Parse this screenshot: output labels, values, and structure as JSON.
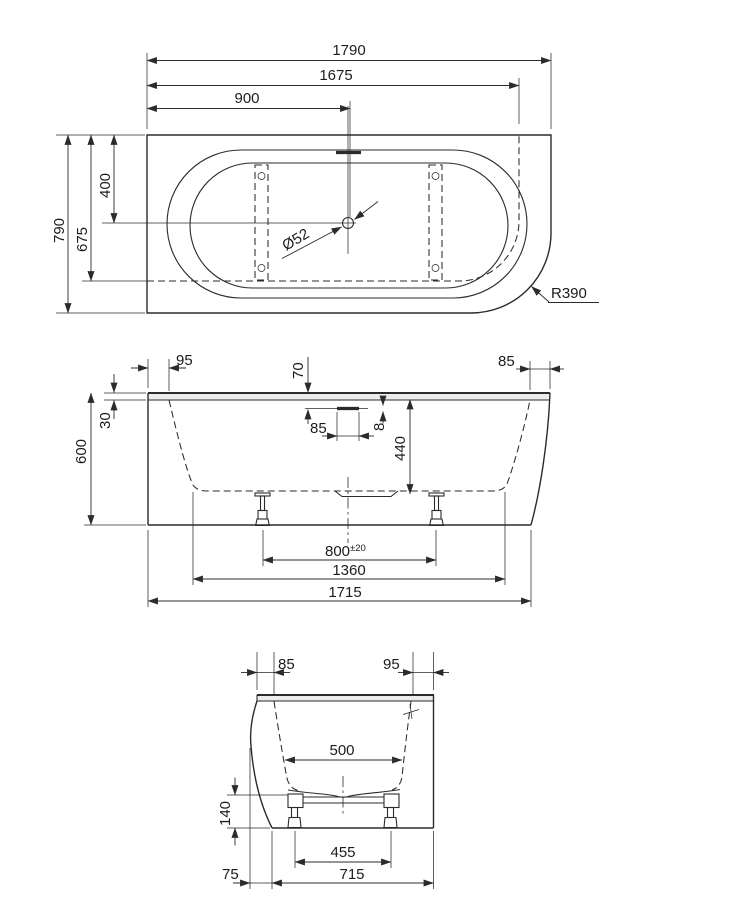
{
  "top_view": {
    "length_overall": "1790",
    "length_to_hidden_edge": "1675",
    "drain_from_left": "900",
    "width_overall": "790",
    "width_to_hidden_edge": "675",
    "drain_from_back": "400",
    "drain_diameter": "Ø52",
    "corner_radius": "R390"
  },
  "front_view": {
    "ledge_left": "95",
    "rim_thickness": "30",
    "overall_height": "600",
    "overflow_below_rim": "70",
    "overflow_width": "85",
    "overflow_height": "8",
    "inner_depth": "440",
    "ledge_right": "85",
    "feet_spacing": "800",
    "feet_spacing_tolerance": "±20",
    "base_length": "1360",
    "bottom_length": "1715"
  },
  "end_view": {
    "ledge_left": "85",
    "ledge_right": "95",
    "inner_width": "500",
    "base_height": "140",
    "feet_spacing": "455",
    "skirt_overhang": "75",
    "bottom_width": "715"
  }
}
